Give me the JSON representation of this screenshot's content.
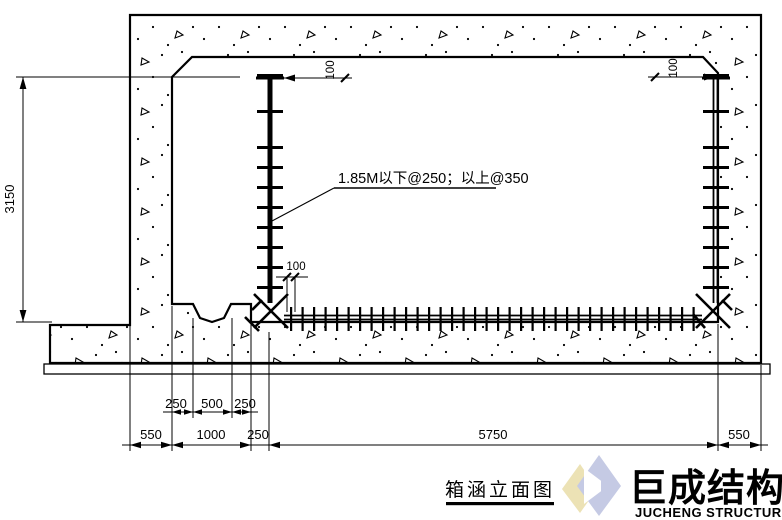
{
  "drawing": {
    "title": "箱涵立面图",
    "rebar_note": "1.85M以下@250；以上@350",
    "dims": {
      "wall_height": "3150",
      "offset_top_left": "100",
      "offset_top_right": "100",
      "offset_floor": "100",
      "channel": [
        "250",
        "500",
        "250"
      ],
      "bottom": [
        "550",
        "1000",
        "250",
        "5750",
        "550"
      ]
    }
  },
  "logo": {
    "zh": "巨成结构",
    "en": "JUCHENG STRUCTURE"
  },
  "colors": {
    "line": "#000000",
    "logo_text": "#c5cae4",
    "logo_diamond": "#c5cae4",
    "logo_accent_yellow": "#ece2b5"
  }
}
